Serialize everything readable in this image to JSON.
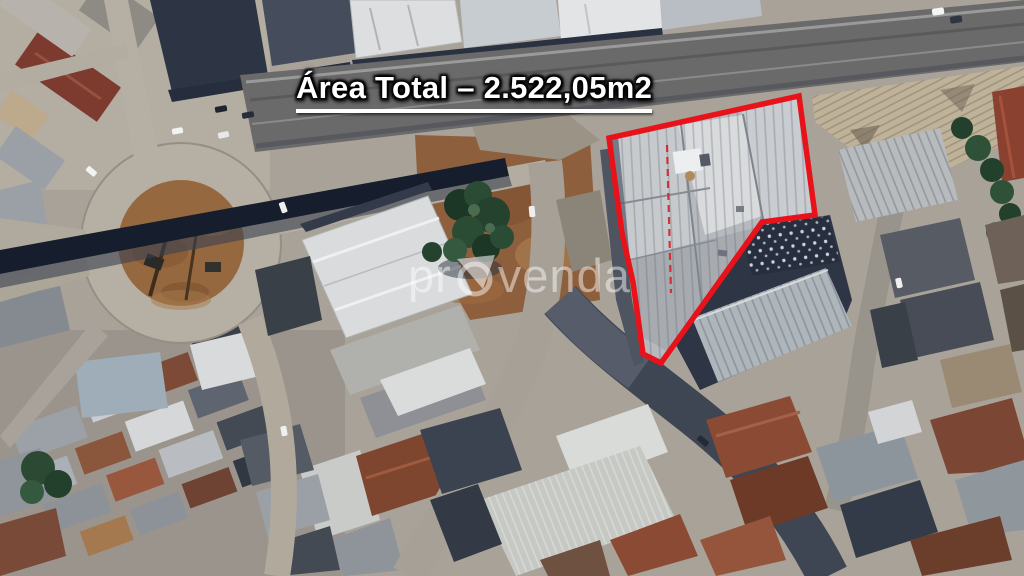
{
  "title": {
    "text": "Área Total – 2.522,05m2"
  },
  "annotation": {
    "area_label": "Área Total",
    "area_value": "2.522,05m2",
    "boundary_color": "#e8121a",
    "dashed_color": "#d2232a",
    "polygon_points": "799,96 609,138 622,233 633,282 643,354 661,363 762,222 815,215",
    "dashed_line": {
      "x1": "667",
      "y1": "145",
      "x2": "671",
      "y2": "293"
    }
  },
  "watermark": {
    "prefix": "pr",
    "suffix": "venda",
    "full": "provenda"
  }
}
